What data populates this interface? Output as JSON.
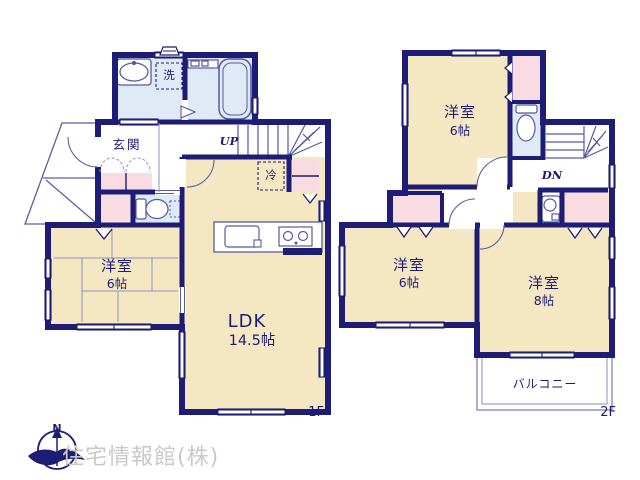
{
  "colors": {
    "wall": "#1d1d75",
    "room_fill": "#f6e7c3",
    "wet_area_fill": "#dfeaf6",
    "closet_fill": "#f9dbe2",
    "thin_line": "#5a5fa5",
    "watermark_gray": "#c9c9c9"
  },
  "floor1": {
    "label": "1F",
    "ldk": {
      "name": "LDK",
      "size": "14.5帖"
    },
    "bedroom": {
      "name": "洋室",
      "size": "6帖"
    },
    "entrance": "玄関",
    "laundry": "洗",
    "fridge": "冷",
    "stairs_up": "UP"
  },
  "floor2": {
    "label": "2F",
    "bedroom_top": {
      "name": "洋室",
      "size": "6帖"
    },
    "bedroom_left": {
      "name": "洋室",
      "size": "6帖"
    },
    "bedroom_right": {
      "name": "洋室",
      "size": "8帖"
    },
    "balcony": "バルコニー",
    "stairs_down": "DN"
  },
  "compass": {
    "north": "N"
  },
  "watermark": "住宅情報館(株)"
}
